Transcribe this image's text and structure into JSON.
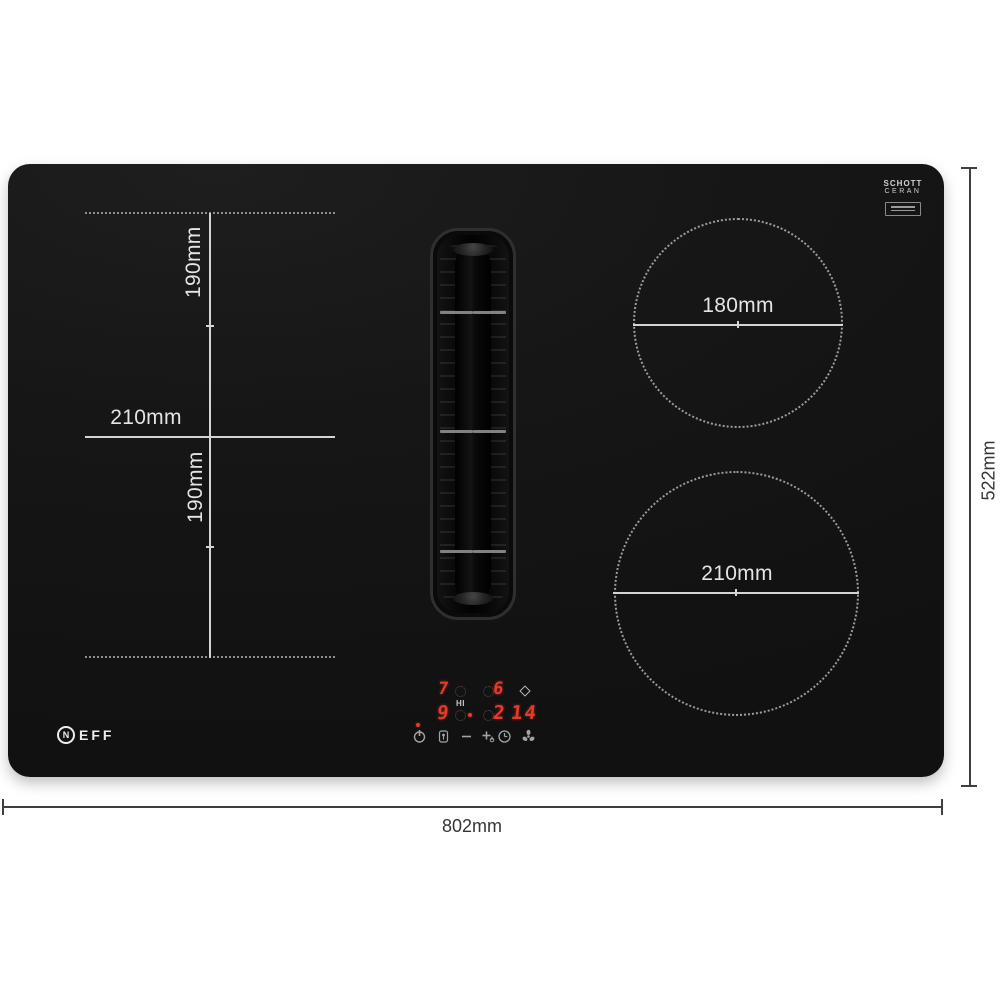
{
  "hob": {
    "colors": {
      "surface": "#161616",
      "zone_line": "#d4d4d4",
      "display_red": "#e23b2c"
    },
    "brand_logo": {
      "initial": "N",
      "rest": "EFF"
    },
    "glass_logo": {
      "line1": "SCHOTT",
      "line2": "CERAN"
    },
    "flex_zone": {
      "top_label": "190mm",
      "width_label": "210mm",
      "bottom_label": "190mm"
    },
    "burner_top_right": {
      "label": "180mm"
    },
    "burner_bottom_right": {
      "label": "210mm"
    },
    "control_panel": {
      "row1": {
        "left_level": "7",
        "right_level": "6",
        "boost_label": "HI"
      },
      "row2": {
        "left_level": "9",
        "right_level": "2",
        "timer_value": "14"
      },
      "icons": [
        {
          "name": "power-icon"
        },
        {
          "name": "child-lock-icon"
        },
        {
          "name": "minus-icon"
        },
        {
          "name": "plus-icon"
        },
        {
          "name": "timer-clock-icon"
        },
        {
          "name": "fan-icon"
        },
        {
          "name": "water-drop-icon"
        }
      ]
    }
  },
  "dimensions": {
    "width_label": "802mm",
    "height_label": "522mm"
  }
}
